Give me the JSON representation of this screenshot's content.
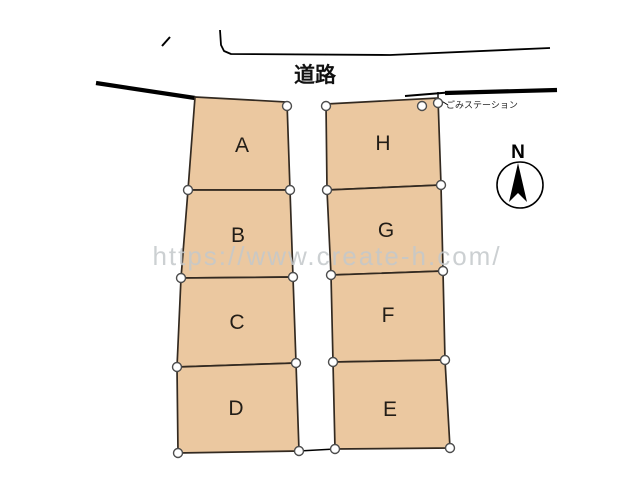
{
  "labels": {
    "road": "道路",
    "garbage_station": "ごみステーション",
    "compass_north": "N",
    "watermark": "https://www.create-h.com/"
  },
  "colors": {
    "background": "#ffffff",
    "lot_fill": "#ebc8a0",
    "lot_stroke": "#332a21",
    "road_line": "#000000",
    "survey_point_fill": "#ffffff",
    "survey_point_stroke": "#4d4d4d",
    "watermark": "#c4c8cb",
    "label_text": "#221d17"
  },
  "diagram": {
    "lots": [
      {
        "id": "A",
        "label": "A",
        "points": [
          [
            195,
            97
          ],
          [
            287,
            102
          ],
          [
            290,
            190
          ],
          [
            188,
            190
          ]
        ],
        "label_pos": [
          242,
          152
        ]
      },
      {
        "id": "B",
        "label": "B",
        "points": [
          [
            188,
            190
          ],
          [
            290,
            190
          ],
          [
            293,
            277
          ],
          [
            181,
            278
          ]
        ],
        "label_pos": [
          238,
          242
        ]
      },
      {
        "id": "C",
        "label": "C",
        "points": [
          [
            181,
            278
          ],
          [
            293,
            277
          ],
          [
            296,
            363
          ],
          [
            177,
            367
          ]
        ],
        "label_pos": [
          237,
          329
        ]
      },
      {
        "id": "D",
        "label": "D",
        "points": [
          [
            177,
            367
          ],
          [
            296,
            363
          ],
          [
            299,
            451
          ],
          [
            178,
            453
          ]
        ],
        "label_pos": [
          236,
          415
        ]
      },
      {
        "id": "H",
        "label": "H",
        "points": [
          [
            326,
            104
          ],
          [
            438,
            98
          ],
          [
            441,
            185
          ],
          [
            327,
            190
          ]
        ],
        "label_pos": [
          383,
          150
        ]
      },
      {
        "id": "G",
        "label": "G",
        "points": [
          [
            327,
            190
          ],
          [
            441,
            185
          ],
          [
            443,
            271
          ],
          [
            331,
            275
          ]
        ],
        "label_pos": [
          386,
          237
        ]
      },
      {
        "id": "F",
        "label": "F",
        "points": [
          [
            331,
            275
          ],
          [
            443,
            271
          ],
          [
            445,
            360
          ],
          [
            333,
            362
          ]
        ],
        "label_pos": [
          388,
          322
        ]
      },
      {
        "id": "E",
        "label": "E",
        "points": [
          [
            333,
            362
          ],
          [
            445,
            360
          ],
          [
            450,
            448
          ],
          [
            335,
            449
          ]
        ],
        "label_pos": [
          390,
          416
        ]
      }
    ],
    "survey_points": [
      [
        287,
        106
      ],
      [
        188,
        190
      ],
      [
        290,
        190
      ],
      [
        181,
        278
      ],
      [
        293,
        277
      ],
      [
        177,
        367
      ],
      [
        296,
        363
      ],
      [
        178,
        453
      ],
      [
        299,
        451
      ],
      [
        326,
        106
      ],
      [
        327,
        190
      ],
      [
        441,
        185
      ],
      [
        331,
        275
      ],
      [
        443,
        271
      ],
      [
        333,
        362
      ],
      [
        445,
        360
      ],
      [
        335,
        449
      ],
      [
        450,
        448
      ],
      [
        422,
        106
      ],
      [
        438,
        103
      ]
    ],
    "road_lines": [
      {
        "name": "road-edge-top",
        "points": [
          [
            220,
            30
          ],
          [
            221,
            45
          ],
          [
            224,
            51
          ],
          [
            231,
            54
          ],
          [
            390,
            55
          ],
          [
            550,
            48
          ]
        ],
        "width": 1.8
      },
      {
        "name": "road-edge-left-thick",
        "points": [
          [
            96,
            83
          ],
          [
            195,
            98
          ]
        ],
        "width": 4.2
      },
      {
        "name": "road-edge-right-lead",
        "points": [
          [
            405,
            96
          ],
          [
            448,
            92.5
          ]
        ],
        "width": 2
      },
      {
        "name": "road-edge-right-thick",
        "points": [
          [
            445,
            93
          ],
          [
            557,
            90
          ]
        ],
        "width": 4.2
      },
      {
        "name": "corner-tick",
        "points": [
          [
            162,
            46
          ],
          [
            170,
            37
          ]
        ],
        "width": 2
      },
      {
        "name": "garbage-road-tick",
        "points": [
          [
            438,
            92
          ],
          [
            438,
            102
          ]
        ],
        "width": 1.4
      },
      {
        "name": "garbage-connector",
        "points": [
          [
            422,
            106
          ],
          [
            438,
            103
          ]
        ],
        "width": 1.4
      },
      {
        "name": "garbage-leader",
        "points": [
          [
            440,
            100
          ],
          [
            448,
            105
          ]
        ],
        "width": 1
      },
      {
        "name": "lot-connector-bottom",
        "points": [
          [
            299,
            451
          ],
          [
            335,
            449
          ]
        ],
        "width": 1.4
      }
    ],
    "compass": {
      "cx": 520,
      "cy": 185,
      "r": 23,
      "arrow_points": [
        [
          518,
          163
        ],
        [
          509,
          202
        ],
        [
          518,
          193
        ],
        [
          527,
          202
        ]
      ]
    }
  }
}
